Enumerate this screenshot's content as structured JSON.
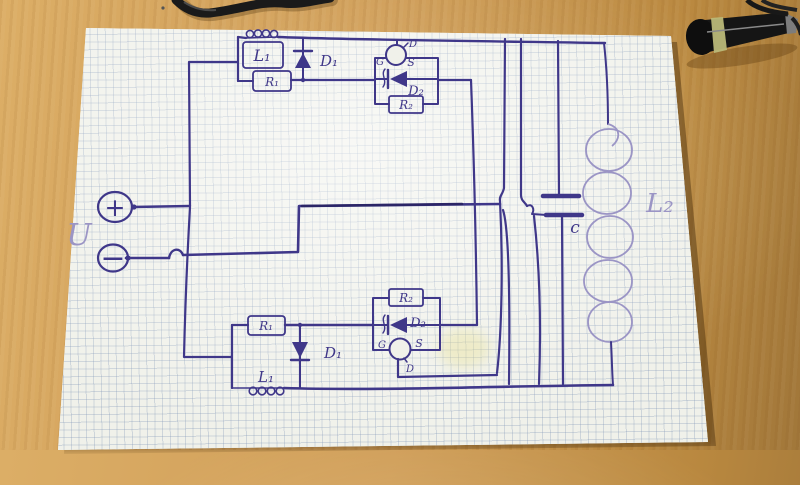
{
  "labels": {
    "source_voltage": "U",
    "source_plus": "+",
    "source_minus": "−",
    "inductor_top": "L₁",
    "resistor_top": "R₁",
    "diode_top": "D₁",
    "gate_top": "G",
    "mosfet_source_top": "S",
    "mosfet_drain_top": "D",
    "diode2_top": "D₂",
    "resistor2_top": "R₂",
    "resistor2_bottom": "R₂",
    "diode2_bottom": "D₂",
    "gate_bottom": "G",
    "mosfet_source_bottom": "S",
    "mosfet_drain_bottom": "D",
    "resistor_bottom": "R₁",
    "diode_bottom": "D₁",
    "inductor_bottom": "L₁",
    "capacitor": "c",
    "inductor_secondary": "L₂"
  },
  "colors": {
    "ink": "#3f3789",
    "ink_dark": "#2b2566",
    "ink_light": "#9b95c5",
    "paper": "#f0f1ea",
    "grid_line": "#7d93b5",
    "desk_wood": "#cf9d58",
    "desk_shadow": "#8f6a33",
    "object_black": "#141414",
    "band_yellow": "#b9b878"
  }
}
